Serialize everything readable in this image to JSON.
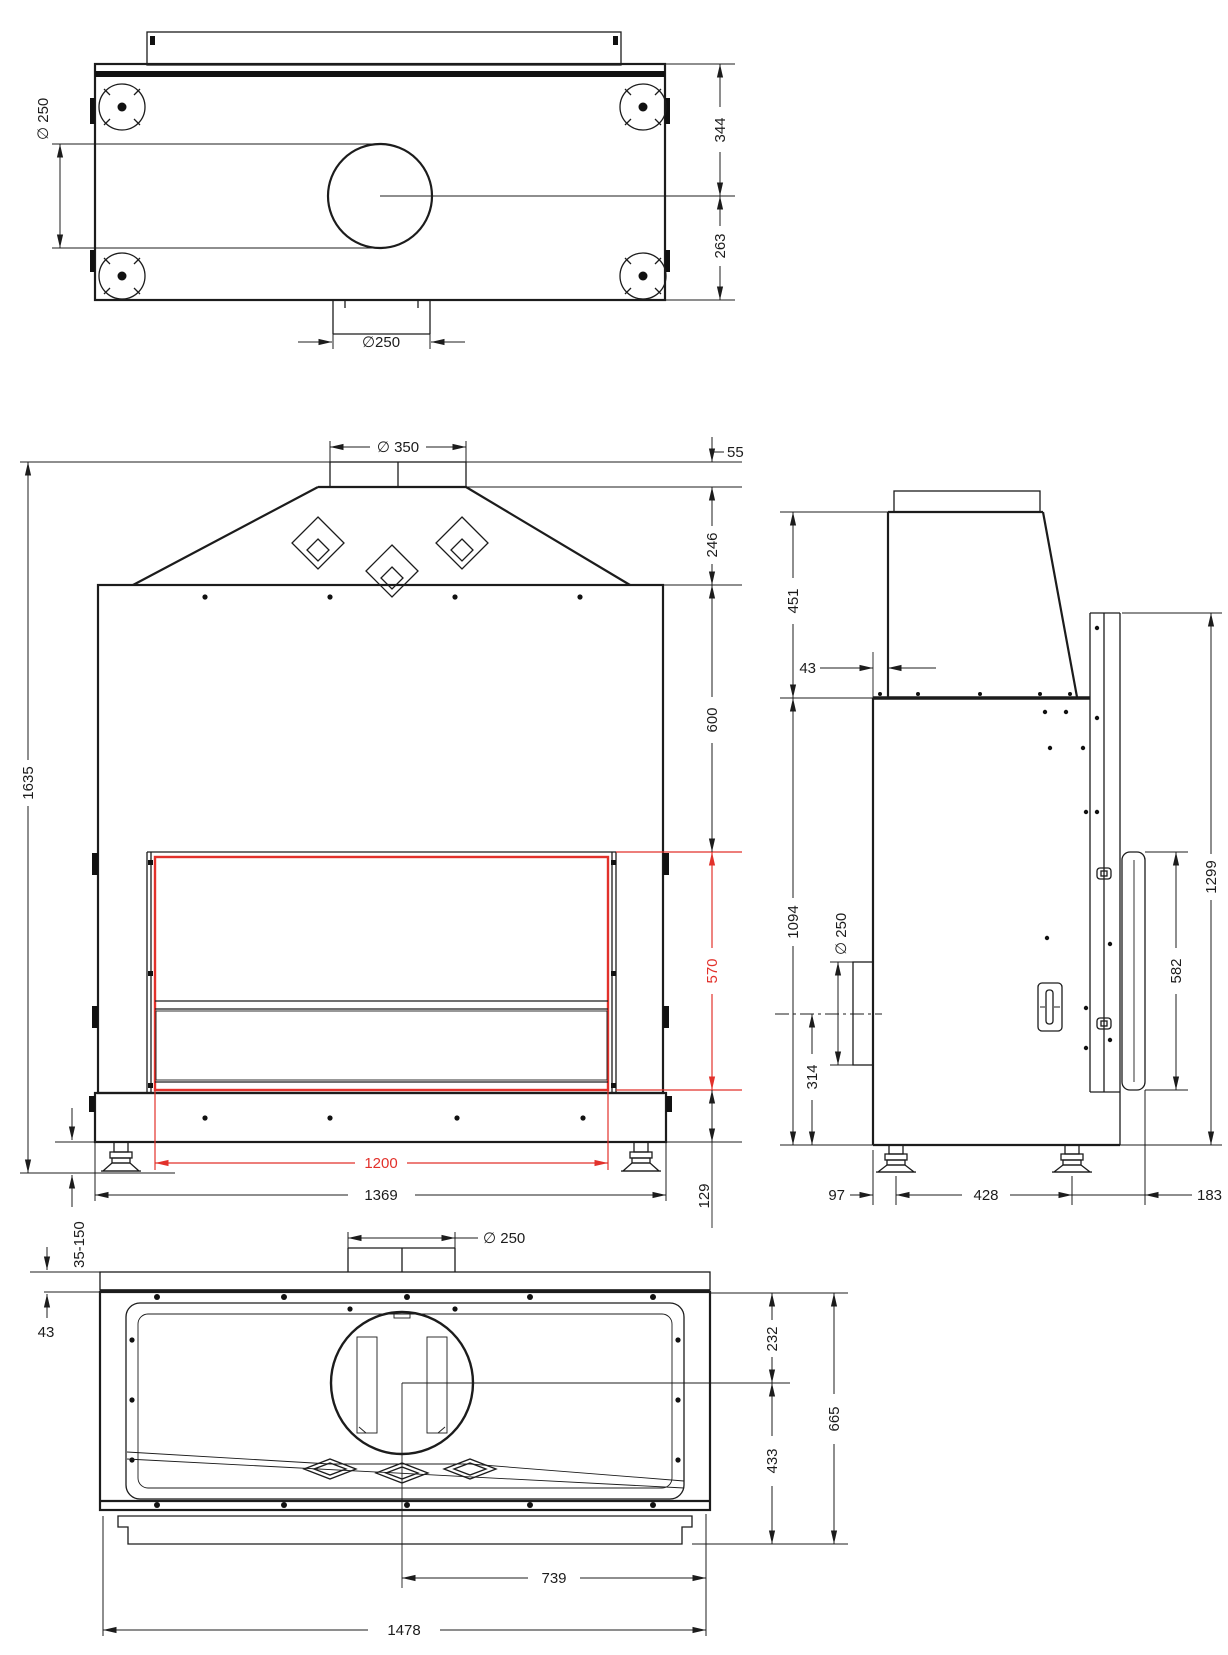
{
  "drawing": {
    "background": "#ffffff",
    "line_color": "#1c1c1c",
    "accent_red": "#e2312b"
  },
  "top_view": {
    "dim_flue_diameter_side": "∅ 250",
    "dim_flue_to_rear": "344",
    "dim_flue_to_front": "263",
    "dim_rear_collar_width": "∅250"
  },
  "front_view": {
    "dim_flue_collar_diameter": "∅ 350",
    "dim_collar_height": "55",
    "dim_hood_height": "246",
    "dim_upper_body_height": "600",
    "dim_glass_height": "570",
    "dim_base_height": "129",
    "dim_total_height": "1635",
    "dim_adjustable_feet": "35-150",
    "dim_glass_width": "1200",
    "dim_body_width": "1369"
  },
  "side_view": {
    "dim_hood_section_height": "451",
    "dim_front_recess": "43",
    "dim_body_section_height": "1094",
    "dim_rear_outlet_diameter": "∅ 250",
    "dim_outlet_center_height": "314",
    "dim_rear_frame_height": "1299",
    "dim_rear_glass_height": "582",
    "dim_front_leg_offset": "97",
    "dim_leg_spacing": "428",
    "dim_rear_overhang": "183"
  },
  "bottom_view": {
    "dim_rear_collar_diameter": "∅ 250",
    "dim_top_plate_thickness": "43",
    "dim_flue_center_to_rear": "232",
    "dim_flue_center_to_front": "433",
    "dim_total_depth": "665",
    "dim_flue_center_offset": "739",
    "dim_total_width": "1478"
  }
}
